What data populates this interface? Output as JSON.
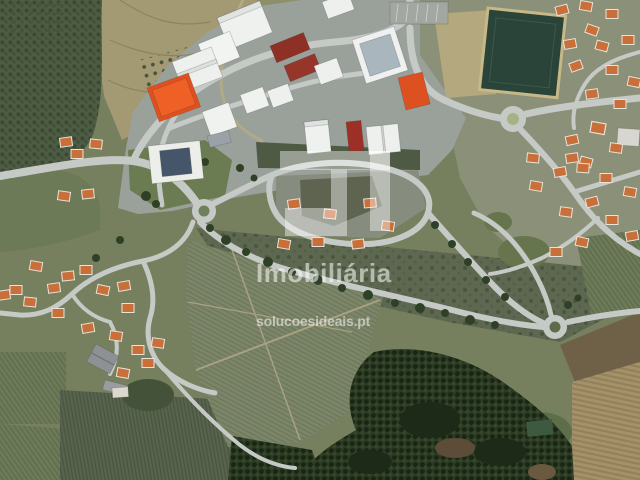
{
  "watermark": {
    "logo_icon": "solucoes-ideais-logo",
    "brand_text": "Imobiliária",
    "website_text": "solucoesideais.pt",
    "text_color": "rgba(255,255,255,0.55)"
  },
  "map": {
    "type": "aerial-satellite-photo",
    "landmarks": [
      "industrial-park-with-white-warehouses",
      "orange-roofed-warehouse",
      "dark-red-warehouses",
      "sports-field",
      "three-roundabouts",
      "housing-development-loop",
      "village-with-orange-roofed-houses",
      "vineyard-fields-with-rows",
      "pine-forest",
      "terraced-farmland",
      "tree-lined-country-road"
    ]
  },
  "palette": {
    "road": "#c6cac6",
    "industrial_ground": "#9aa19b",
    "warehouse_white": "#f0f2f0",
    "warehouse_orange": "#e0501e",
    "warehouse_darkred": "#8e3026",
    "house_roof_orange": "#c86f3a",
    "field_green": "#7c8568",
    "forest_dark": "#2b3b22",
    "farmland_tan": "#a39a74",
    "sports_field_green": "#2a443a"
  }
}
